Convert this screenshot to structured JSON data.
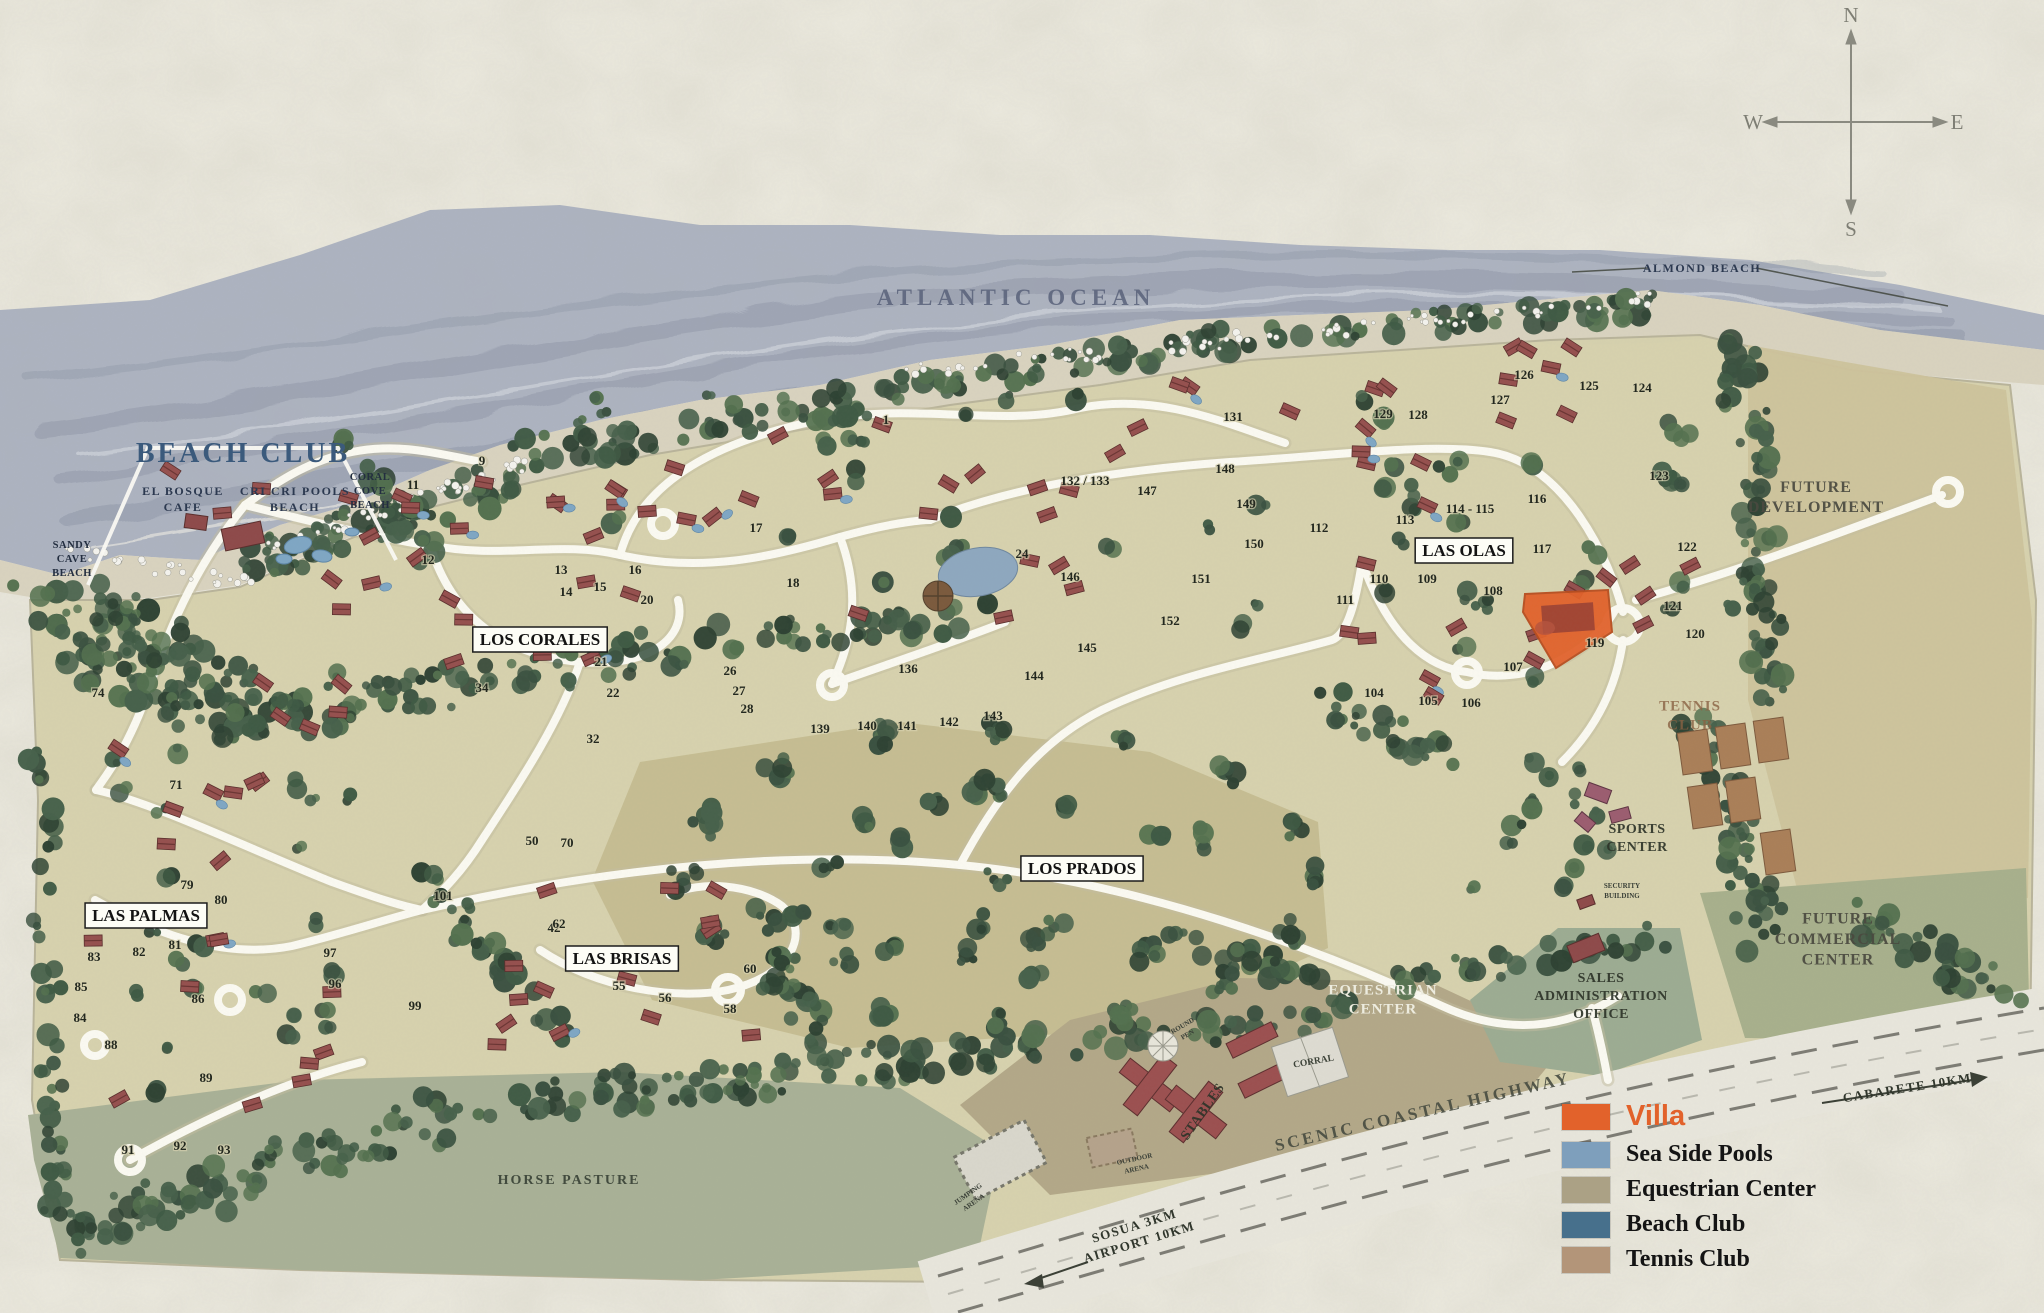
{
  "compass": {
    "n": "N",
    "e": "E",
    "s": "S",
    "w": "W"
  },
  "legend": {
    "items": [
      {
        "label": "Villa",
        "color": "#E2622B"
      },
      {
        "label": "Sea Side Pools",
        "color": "#7E9FBC"
      },
      {
        "label": "Equestrian Center",
        "color": "#ABA185"
      },
      {
        "label": "Beach Club",
        "color": "#47708C"
      },
      {
        "label": "Tennis Club",
        "color": "#B39579"
      }
    ]
  },
  "villa_highlight": {
    "legend_label": "Villa",
    "color": "#E2622B"
  },
  "labels": [
    {
      "id": "atlantic-ocean",
      "lines": [
        "ATLANTIC OCEAN"
      ],
      "x": 1016,
      "y": 305,
      "cls": "ocean",
      "rot": 0
    },
    {
      "id": "almond-beach",
      "lines": [
        "ALMOND BEACH"
      ],
      "x": 1702,
      "y": 272,
      "cls": "beach",
      "rot": 0
    },
    {
      "id": "beach-club",
      "lines": [
        "BEACH CLUB"
      ],
      "x": 243,
      "y": 462,
      "cls": "beachclub",
      "rot": 0
    },
    {
      "id": "el-bosque-cafe",
      "lines": [
        "EL BOSQUE",
        "CAFE"
      ],
      "x": 183,
      "y": 503,
      "cls": "beach",
      "rot": 0
    },
    {
      "id": "cri-cri-pools-beach",
      "lines": [
        "CRI CRI POOLS",
        "BEACH"
      ],
      "x": 295,
      "y": 503,
      "cls": "beach",
      "rot": 0
    },
    {
      "id": "coral-cove-beach",
      "lines": [
        "CORAL",
        "COVE",
        "BEACH"
      ],
      "x": 370,
      "y": 494,
      "cls": "cove",
      "rot": 0
    },
    {
      "id": "sandy-cave-beach",
      "lines": [
        "SANDY",
        "CAVE",
        "BEACH"
      ],
      "x": 72,
      "y": 562,
      "cls": "cove",
      "rot": 0
    },
    {
      "id": "los-corales",
      "lines": [
        "LOS CORALES"
      ],
      "x": 540,
      "y": 645,
      "cls": "boxed",
      "rot": 0
    },
    {
      "id": "las-olas",
      "lines": [
        "LAS OLAS"
      ],
      "x": 1464,
      "y": 556,
      "cls": "boxed",
      "rot": 0
    },
    {
      "id": "los-prados",
      "lines": [
        "LOS PRADOS"
      ],
      "x": 1082,
      "y": 874,
      "cls": "boxed",
      "rot": 0
    },
    {
      "id": "las-palmas",
      "lines": [
        "LAS PALMAS"
      ],
      "x": 146,
      "y": 921,
      "cls": "boxed",
      "rot": 0
    },
    {
      "id": "las-brisas",
      "lines": [
        "LAS BRISAS"
      ],
      "x": 622,
      "y": 964,
      "cls": "boxed",
      "rot": 0
    },
    {
      "id": "future-development",
      "lines": [
        "FUTURE",
        "DEVELOPMENT"
      ],
      "x": 1816,
      "y": 502,
      "cls": "big",
      "rot": 0
    },
    {
      "id": "tennis-club",
      "lines": [
        "TENNIS",
        "CLUB"
      ],
      "x": 1690,
      "y": 720,
      "cls": "brown",
      "rot": 0
    },
    {
      "id": "sports-center",
      "lines": [
        "SPORTS",
        "CENTER"
      ],
      "x": 1637,
      "y": 842,
      "cls": "dark",
      "rot": 0
    },
    {
      "id": "future-commercial-center",
      "lines": [
        "FUTURE",
        "COMMERCIAL",
        "CENTER"
      ],
      "x": 1838,
      "y": 944,
      "cls": "big",
      "rot": 0
    },
    {
      "id": "sales-administration-office",
      "lines": [
        "SALES",
        "ADMINISTRATION",
        "OFFICE"
      ],
      "x": 1601,
      "y": 1000,
      "cls": "dark",
      "rot": 0
    },
    {
      "id": "equestrian-center",
      "lines": [
        "EQUESTRIAN",
        "CENTER"
      ],
      "x": 1383,
      "y": 1004,
      "cls": "light",
      "rot": 0
    },
    {
      "id": "corral",
      "lines": [
        "CORRAL"
      ],
      "x": 1314,
      "y": 1064,
      "cls": "small",
      "rot": -10
    },
    {
      "id": "stables",
      "lines": [
        "STABLES"
      ],
      "x": 1206,
      "y": 1114,
      "cls": "dark",
      "rot": -55
    },
    {
      "id": "round-pen",
      "lines": [
        "ROUND",
        "PEN"
      ],
      "x": 1186,
      "y": 1032,
      "cls": "tiny",
      "rot": -30
    },
    {
      "id": "jumping-arena",
      "lines": [
        "JUMPING",
        "ARENA"
      ],
      "x": 972,
      "y": 1200,
      "cls": "tiny",
      "rot": -35
    },
    {
      "id": "outdoor-arena",
      "lines": [
        "OUTDOOR",
        "ARENA"
      ],
      "x": 1136,
      "y": 1166,
      "cls": "tiny",
      "rot": -12
    },
    {
      "id": "security-building",
      "lines": [
        "SECURITY",
        "BUILDING"
      ],
      "x": 1622,
      "y": 893,
      "cls": "tiny",
      "rot": 0
    },
    {
      "id": "horse-pasture",
      "lines": [
        "HORSE PASTURE"
      ],
      "x": 569,
      "y": 1184,
      "cls": "pasture",
      "rot": 0
    },
    {
      "id": "scenic-coastal-highway",
      "lines": [
        "SCENIC COASTAL HIGHWAY"
      ],
      "x": 1424,
      "y": 1117,
      "cls": "hwy",
      "rot": -13
    },
    {
      "id": "cabarete-distance",
      "lines": [
        "CABARETE 10KM"
      ],
      "x": 1908,
      "y": 1092,
      "cls": "dir",
      "rot": -9
    },
    {
      "id": "sosua-airport-distance",
      "lines": [
        "SOSUA 3KM",
        "AIRPORT 10KM"
      ],
      "x": 1138,
      "y": 1238,
      "cls": "dir",
      "rot": -17
    }
  ],
  "lots": [
    {
      "n": "1",
      "x": 886,
      "y": 424
    },
    {
      "n": "9",
      "x": 482,
      "y": 465
    },
    {
      "n": "11",
      "x": 413,
      "y": 489
    },
    {
      "n": "12",
      "x": 428,
      "y": 564
    },
    {
      "n": "13",
      "x": 561,
      "y": 574
    },
    {
      "n": "14",
      "x": 566,
      "y": 596
    },
    {
      "n": "15",
      "x": 600,
      "y": 591
    },
    {
      "n": "16",
      "x": 635,
      "y": 574
    },
    {
      "n": "17",
      "x": 756,
      "y": 532
    },
    {
      "n": "18",
      "x": 793,
      "y": 587
    },
    {
      "n": "20",
      "x": 647,
      "y": 604
    },
    {
      "n": "21",
      "x": 601,
      "y": 666
    },
    {
      "n": "22",
      "x": 613,
      "y": 697
    },
    {
      "n": "24",
      "x": 1022,
      "y": 558
    },
    {
      "n": "26",
      "x": 730,
      "y": 675
    },
    {
      "n": "27",
      "x": 739,
      "y": 695
    },
    {
      "n": "28",
      "x": 747,
      "y": 713
    },
    {
      "n": "32",
      "x": 593,
      "y": 743
    },
    {
      "n": "34",
      "x": 482,
      "y": 692
    },
    {
      "n": "42",
      "x": 554,
      "y": 932
    },
    {
      "n": "50",
      "x": 532,
      "y": 845
    },
    {
      "n": "55",
      "x": 619,
      "y": 990
    },
    {
      "n": "56",
      "x": 665,
      "y": 1002
    },
    {
      "n": "58",
      "x": 730,
      "y": 1013
    },
    {
      "n": "60",
      "x": 750,
      "y": 973
    },
    {
      "n": "62",
      "x": 559,
      "y": 928
    },
    {
      "n": "70",
      "x": 567,
      "y": 847
    },
    {
      "n": "71",
      "x": 176,
      "y": 789
    },
    {
      "n": "74",
      "x": 98,
      "y": 697
    },
    {
      "n": "79",
      "x": 187,
      "y": 889
    },
    {
      "n": "80",
      "x": 221,
      "y": 904
    },
    {
      "n": "81",
      "x": 175,
      "y": 949
    },
    {
      "n": "82",
      "x": 139,
      "y": 956
    },
    {
      "n": "83",
      "x": 94,
      "y": 961
    },
    {
      "n": "84",
      "x": 80,
      "y": 1022
    },
    {
      "n": "85",
      "x": 81,
      "y": 991
    },
    {
      "n": "86",
      "x": 198,
      "y": 1003
    },
    {
      "n": "88",
      "x": 111,
      "y": 1049
    },
    {
      "n": "89",
      "x": 206,
      "y": 1082
    },
    {
      "n": "91",
      "x": 128,
      "y": 1154
    },
    {
      "n": "92",
      "x": 180,
      "y": 1150
    },
    {
      "n": "93",
      "x": 224,
      "y": 1154
    },
    {
      "n": "96",
      "x": 335,
      "y": 988
    },
    {
      "n": "97",
      "x": 330,
      "y": 957
    },
    {
      "n": "99",
      "x": 415,
      "y": 1010
    },
    {
      "n": "101",
      "x": 443,
      "y": 900
    },
    {
      "n": "104",
      "x": 1374,
      "y": 697
    },
    {
      "n": "105",
      "x": 1428,
      "y": 705
    },
    {
      "n": "106",
      "x": 1471,
      "y": 707
    },
    {
      "n": "107",
      "x": 1513,
      "y": 671
    },
    {
      "n": "108",
      "x": 1493,
      "y": 595
    },
    {
      "n": "109",
      "x": 1427,
      "y": 583
    },
    {
      "n": "110",
      "x": 1379,
      "y": 583
    },
    {
      "n": "111",
      "x": 1345,
      "y": 604
    },
    {
      "n": "112",
      "x": 1319,
      "y": 532
    },
    {
      "n": "113",
      "x": 1405,
      "y": 524
    },
    {
      "n": "114 - 115",
      "x": 1470,
      "y": 513
    },
    {
      "n": "116",
      "x": 1537,
      "y": 503
    },
    {
      "n": "117",
      "x": 1542,
      "y": 553
    },
    {
      "n": "119",
      "x": 1595,
      "y": 647
    },
    {
      "n": "120",
      "x": 1695,
      "y": 638
    },
    {
      "n": "121",
      "x": 1673,
      "y": 610
    },
    {
      "n": "122",
      "x": 1687,
      "y": 551
    },
    {
      "n": "123",
      "x": 1659,
      "y": 480
    },
    {
      "n": "124",
      "x": 1642,
      "y": 392
    },
    {
      "n": "125",
      "x": 1589,
      "y": 390
    },
    {
      "n": "126",
      "x": 1524,
      "y": 379
    },
    {
      "n": "127",
      "x": 1500,
      "y": 404
    },
    {
      "n": "128",
      "x": 1418,
      "y": 419
    },
    {
      "n": "129",
      "x": 1383,
      "y": 418
    },
    {
      "n": "131",
      "x": 1233,
      "y": 421
    },
    {
      "n": "132 / 133",
      "x": 1085,
      "y": 485
    },
    {
      "n": "136",
      "x": 908,
      "y": 673
    },
    {
      "n": "139",
      "x": 820,
      "y": 733
    },
    {
      "n": "140",
      "x": 867,
      "y": 730
    },
    {
      "n": "141",
      "x": 907,
      "y": 730
    },
    {
      "n": "142",
      "x": 949,
      "y": 726
    },
    {
      "n": "143",
      "x": 993,
      "y": 720
    },
    {
      "n": "144",
      "x": 1034,
      "y": 680
    },
    {
      "n": "145",
      "x": 1087,
      "y": 652
    },
    {
      "n": "146",
      "x": 1070,
      "y": 581
    },
    {
      "n": "147",
      "x": 1147,
      "y": 495
    },
    {
      "n": "148",
      "x": 1225,
      "y": 473
    },
    {
      "n": "149",
      "x": 1246,
      "y": 508
    },
    {
      "n": "150",
      "x": 1254,
      "y": 548
    },
    {
      "n": "151",
      "x": 1201,
      "y": 583
    },
    {
      "n": "152",
      "x": 1170,
      "y": 625
    }
  ]
}
